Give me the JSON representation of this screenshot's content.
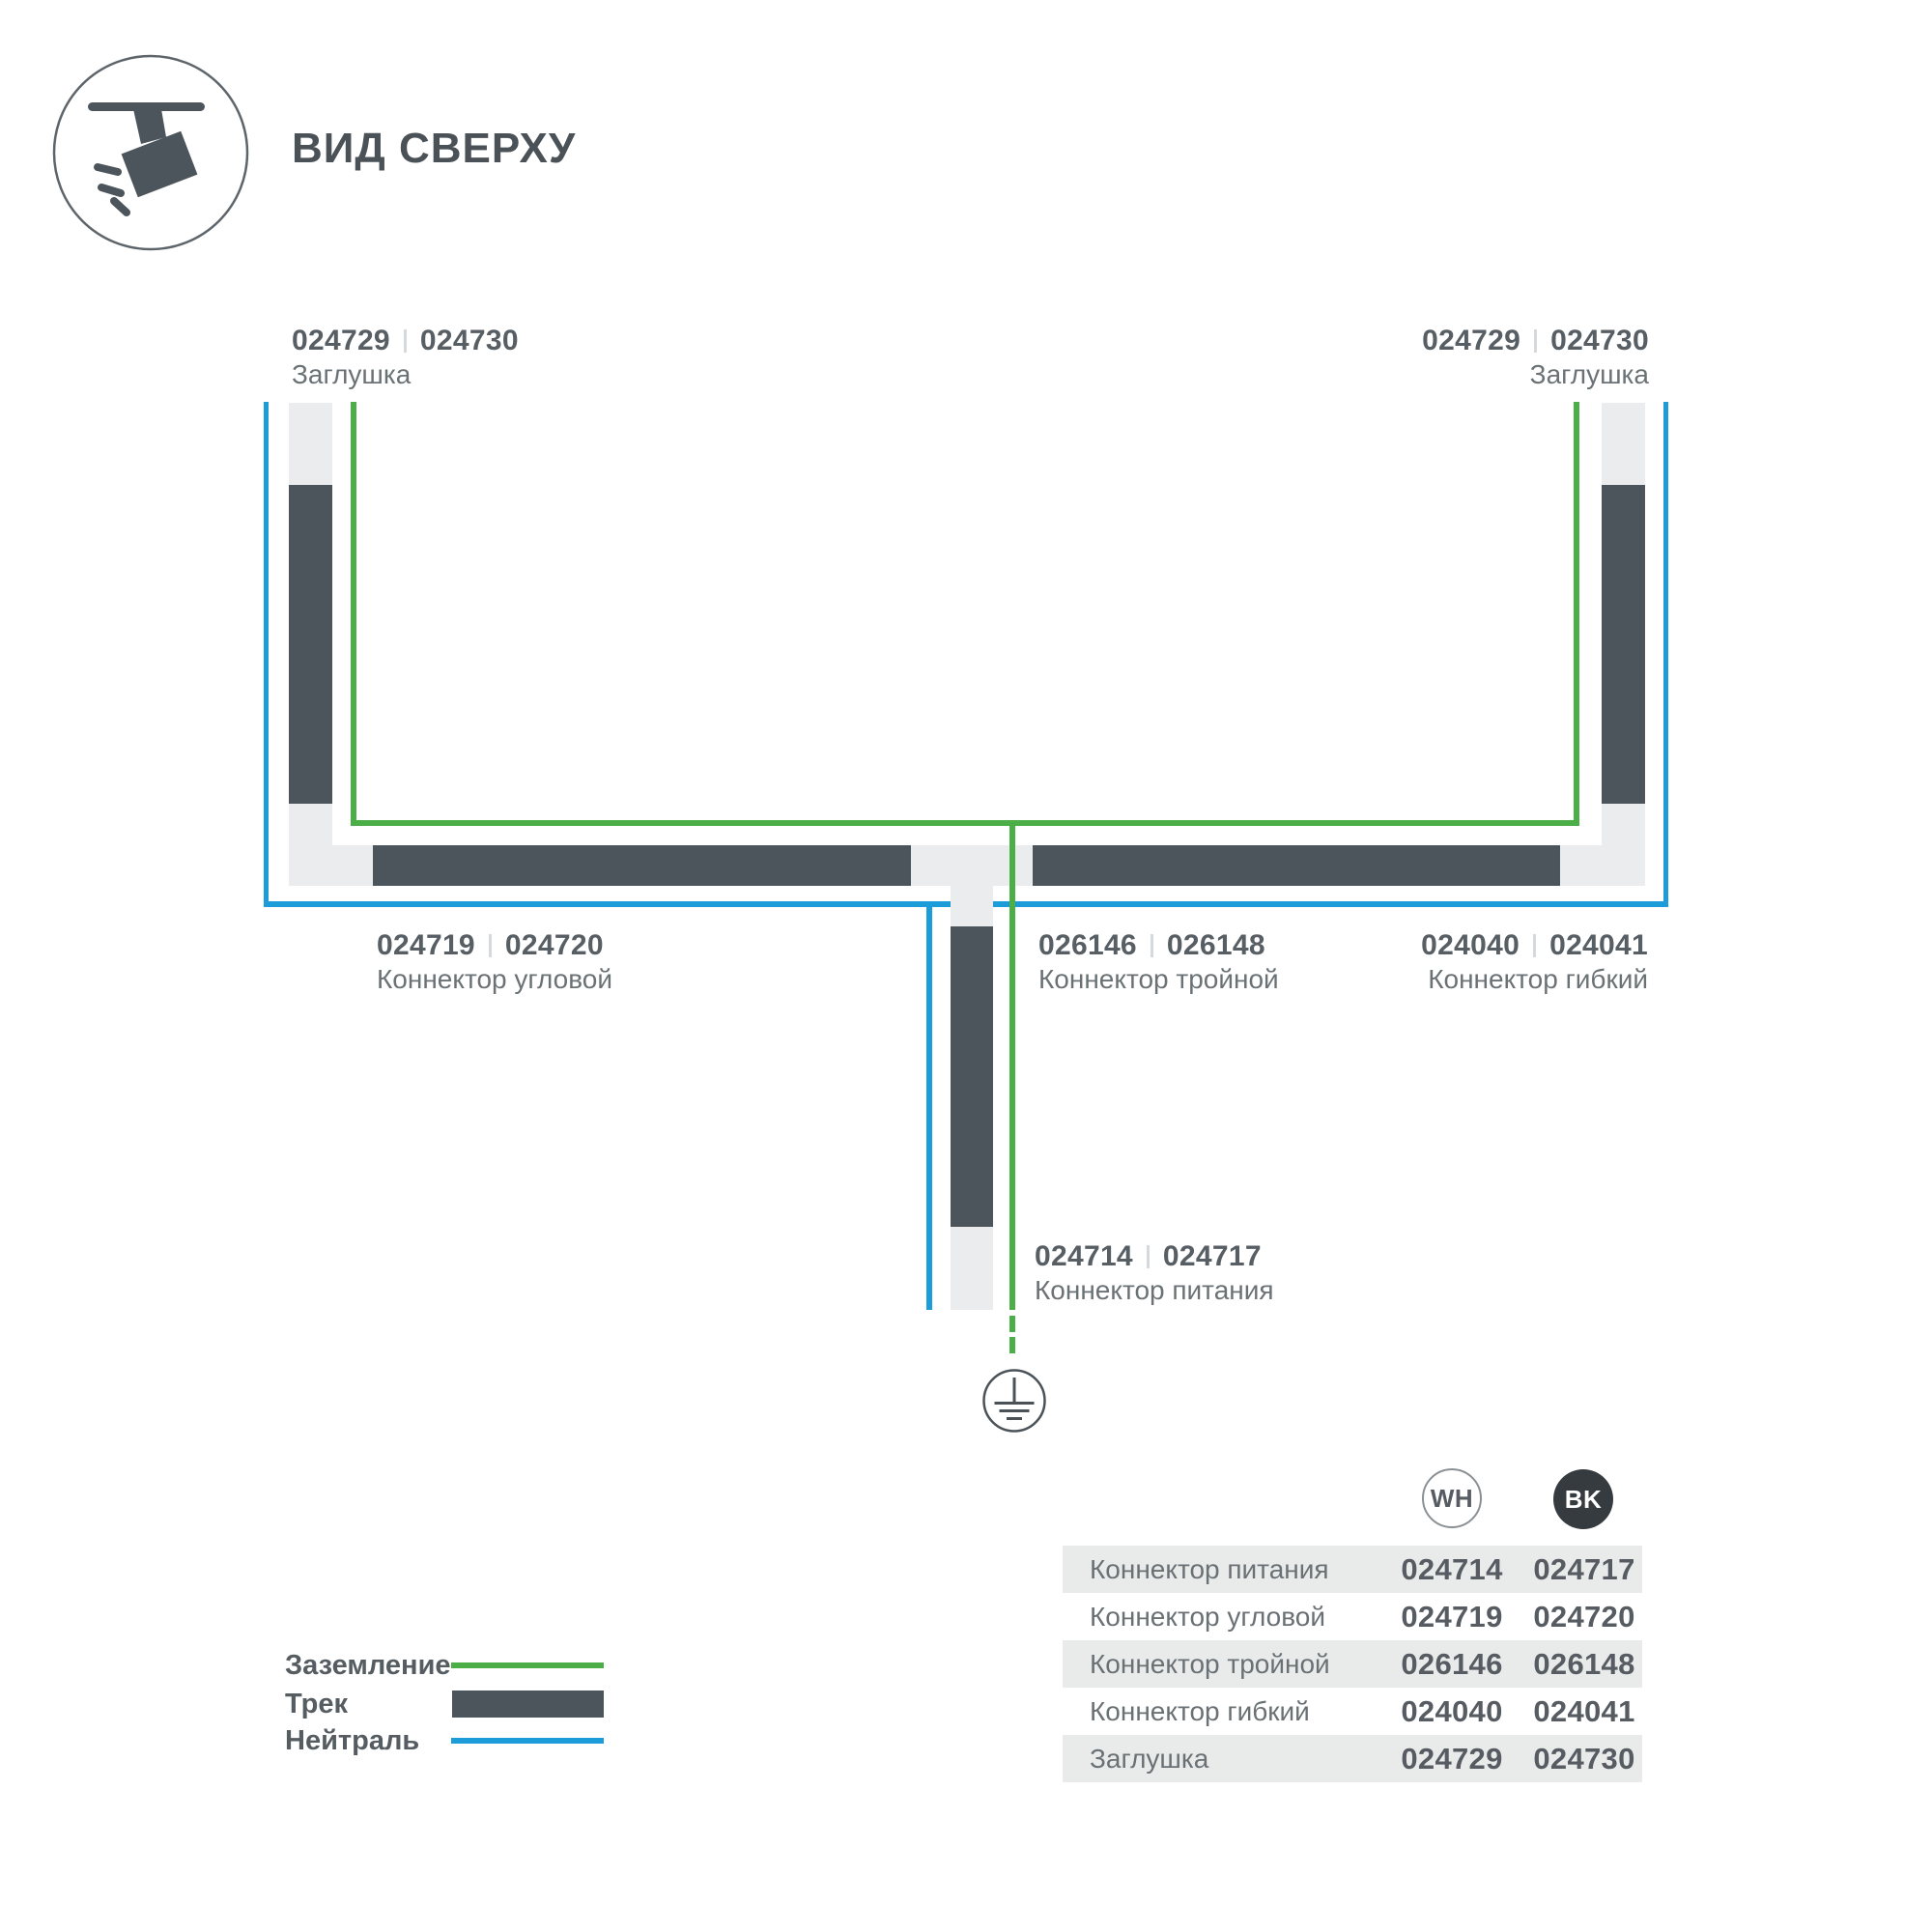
{
  "header": {
    "title": "ВИД СВЕРХУ"
  },
  "colors": {
    "track": "#4d555c",
    "track_connector": "#eaeced",
    "ground_wire": "#4cae46",
    "neutral_wire": "#1c9dd9",
    "table_stripe": "#e9ebeb",
    "bk_badge": "#363b40"
  },
  "diagram": {
    "endcap_left": {
      "code_wh": "024729",
      "code_bk": "024730",
      "name": "Заглушка"
    },
    "endcap_right": {
      "code_wh": "024729",
      "code_bk": "024730",
      "name": "Заглушка"
    },
    "corner": {
      "code_wh": "024719",
      "code_bk": "024720",
      "name": "Коннектор угловой"
    },
    "triple": {
      "code_wh": "026146",
      "code_bk": "026148",
      "name": "Коннектор тройной"
    },
    "flexible": {
      "code_wh": "024040",
      "code_bk": "024041",
      "name": "Коннектор гибкий"
    },
    "power": {
      "code_wh": "024714",
      "code_bk": "024717",
      "name": "Коннектор питания"
    }
  },
  "legend": {
    "ground": "Заземление",
    "track": "Трек",
    "neutral": "Нейтраль"
  },
  "table": {
    "col_wh": "WH",
    "col_bk": "BK",
    "rows": [
      {
        "name": "Коннектор питания",
        "wh": "024714",
        "bk": "024717"
      },
      {
        "name": "Коннектор угловой",
        "wh": "024719",
        "bk": "024720"
      },
      {
        "name": "Коннектор тройной",
        "wh": "026146",
        "bk": "026148"
      },
      {
        "name": "Коннектор гибкий",
        "wh": "024040",
        "bk": "024041"
      },
      {
        "name": "Заглушка",
        "wh": "024729",
        "bk": "024730"
      }
    ]
  }
}
